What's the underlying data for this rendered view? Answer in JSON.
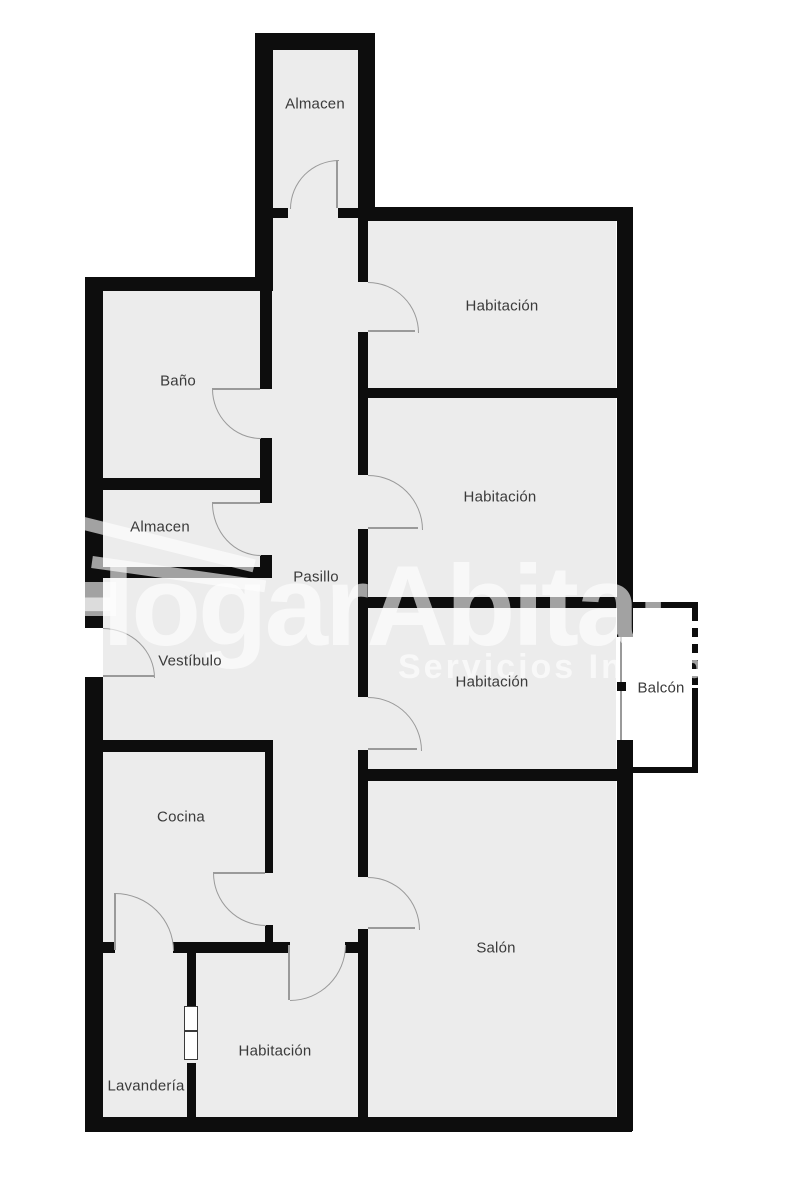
{
  "plan": {
    "rooms": [
      {
        "id": "almacen-top",
        "label": "Almacen"
      },
      {
        "id": "habitacion-1",
        "label": "Habitación"
      },
      {
        "id": "bano",
        "label": "Baño"
      },
      {
        "id": "habitacion-2",
        "label": "Habitación"
      },
      {
        "id": "almacen-2",
        "label": "Almacen"
      },
      {
        "id": "pasillo",
        "label": "Pasillo"
      },
      {
        "id": "vestibulo",
        "label": "Vestíbulo"
      },
      {
        "id": "habitacion-3",
        "label": "Habitación"
      },
      {
        "id": "balcon",
        "label": "Balcón"
      },
      {
        "id": "cocina",
        "label": "Cocina"
      },
      {
        "id": "salon",
        "label": "Salón"
      },
      {
        "id": "habitacion-4",
        "label": "Habitación"
      },
      {
        "id": "lavanderia",
        "label": "Lavandería"
      }
    ]
  },
  "watermark": {
    "title": "HogarAbitat",
    "subtitle": "Servicios Inmobiliarios"
  },
  "colors": {
    "wall": "#0d0d0d",
    "floor": "#ececec",
    "door_arc": "#9a9a9a",
    "room_label": "#3a3a3a",
    "watermark": "rgba(255,255,255,0.62)",
    "background": "#ffffff"
  }
}
